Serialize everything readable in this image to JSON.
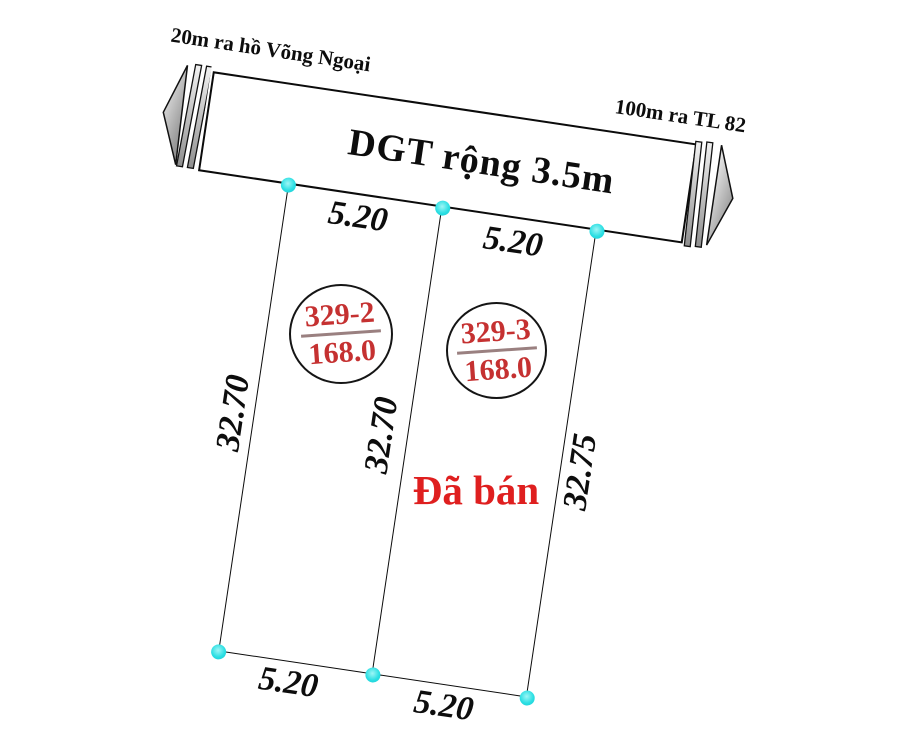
{
  "road": {
    "label": "DGT rộng 3.5m",
    "left_note": "20m ra hồ Võng Ngoại",
    "right_note": "100m ra TL 82"
  },
  "parcels": [
    {
      "id": "329-2",
      "area": "168.0",
      "status": ""
    },
    {
      "id": "329-3",
      "area": "168.0",
      "status": "Đã bán"
    }
  ],
  "dims": {
    "top": [
      "5.20",
      "5.20"
    ],
    "bottom": [
      "5.20",
      "5.20"
    ],
    "sides": [
      "32.70",
      "32.70",
      "32.75"
    ]
  },
  "colors": {
    "line_black": "#0b0b0b",
    "parcel_label_red": "#c53131",
    "sold_red": "#df1f1f",
    "corner_marker_cyan": "#2cdfe3",
    "arrow_gray_light": "#f2f2f2",
    "arrow_gray_dark": "#8f8f8f"
  },
  "icons": {
    "left_arrow": "left-direction-arrow",
    "right_arrow": "right-direction-arrow"
  }
}
